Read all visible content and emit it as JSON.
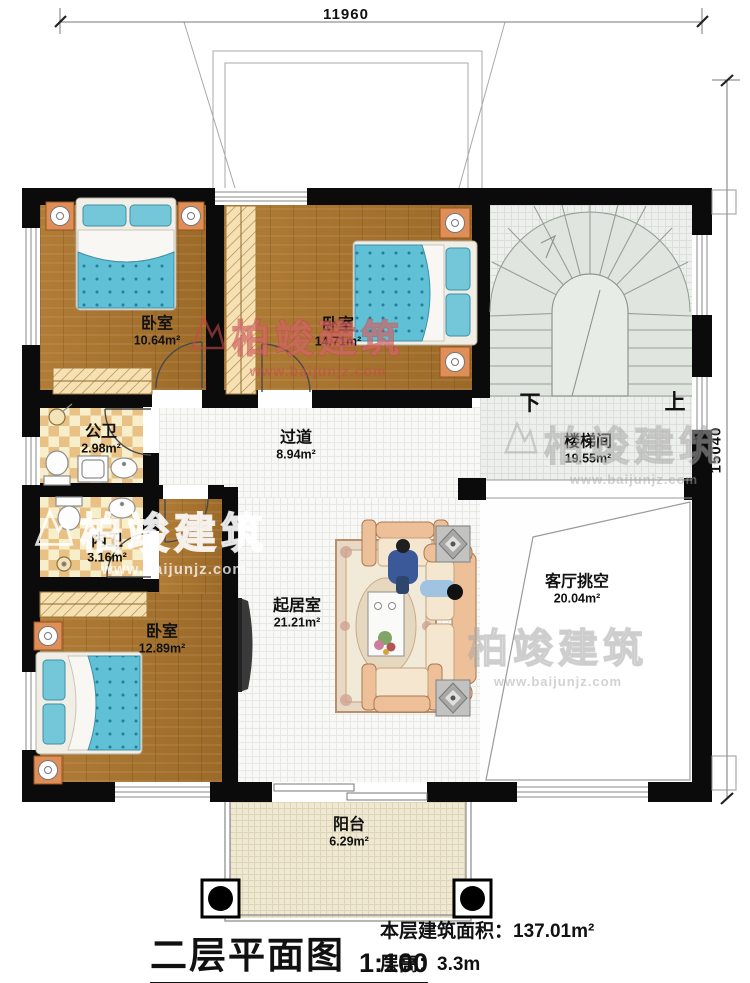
{
  "dimensions": {
    "width_mm": "11960",
    "height_mm": "15040"
  },
  "stairs": {
    "down": "下",
    "up": "上"
  },
  "rooms": [
    {
      "id": "bedroom-1",
      "name": "卧室",
      "area": "10.64m²"
    },
    {
      "id": "bedroom-2",
      "name": "卧室",
      "area": "14.71m²"
    },
    {
      "id": "stairwell",
      "name": "楼梯间",
      "area": "19.55m²"
    },
    {
      "id": "public-bath",
      "name": "公卫",
      "area": "2.98m²"
    },
    {
      "id": "hallway",
      "name": "过道",
      "area": "8.94m²"
    },
    {
      "id": "private-bath",
      "name": "内卫",
      "area": "3.16m²"
    },
    {
      "id": "bedroom-3",
      "name": "卧室",
      "area": "12.89m²"
    },
    {
      "id": "living-room",
      "name": "起居室",
      "area": "21.21m²"
    },
    {
      "id": "void",
      "name": "客厅挑空",
      "area": "20.04m²"
    },
    {
      "id": "balcony",
      "name": "阳台",
      "area": "6.29m²"
    }
  ],
  "title": {
    "plan": "二层平面图",
    "scale": "1:100",
    "area_label": "本层建筑面积：",
    "area_value": "137.01m²",
    "height_label": "层高：",
    "height_value": "3.3m"
  },
  "watermark": {
    "brand": "柏竣建筑",
    "site": "www.baijunjz.com"
  },
  "colors": {
    "wall": "#0b0b0b",
    "bed": "#5fc0d6",
    "nightstand": "#e08e58",
    "watermark_red": "#c64a4a"
  }
}
